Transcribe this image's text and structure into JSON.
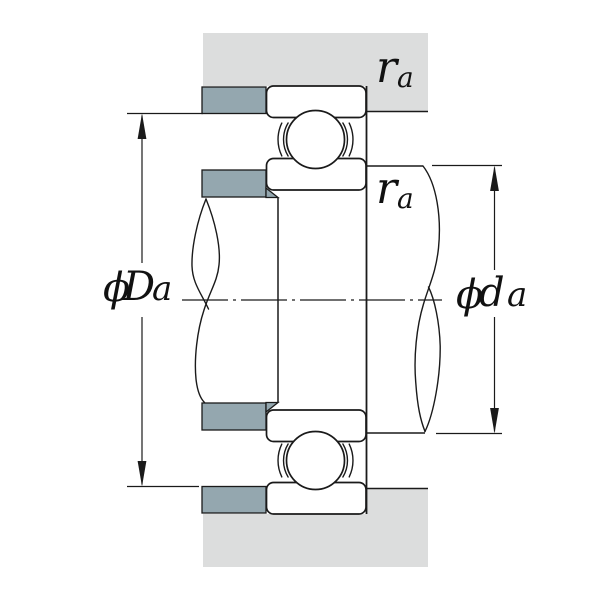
{
  "labels": {
    "ra_housing": {
      "base": "r",
      "sub": "a"
    },
    "ra_shaft": {
      "base": "r",
      "sub": "a"
    },
    "housing_shoulder_diameter": {
      "phi": "ϕ",
      "letter": "D",
      "sub": "a"
    },
    "shaft_shoulder_diameter": {
      "phi": "ϕ",
      "letter": "d",
      "sub": "a"
    }
  },
  "colors": {
    "background": "#ffffff",
    "housing_fill": "#dcdddd",
    "shoulder_block_fill": "#94a7af",
    "line": "#1a1a1a"
  }
}
